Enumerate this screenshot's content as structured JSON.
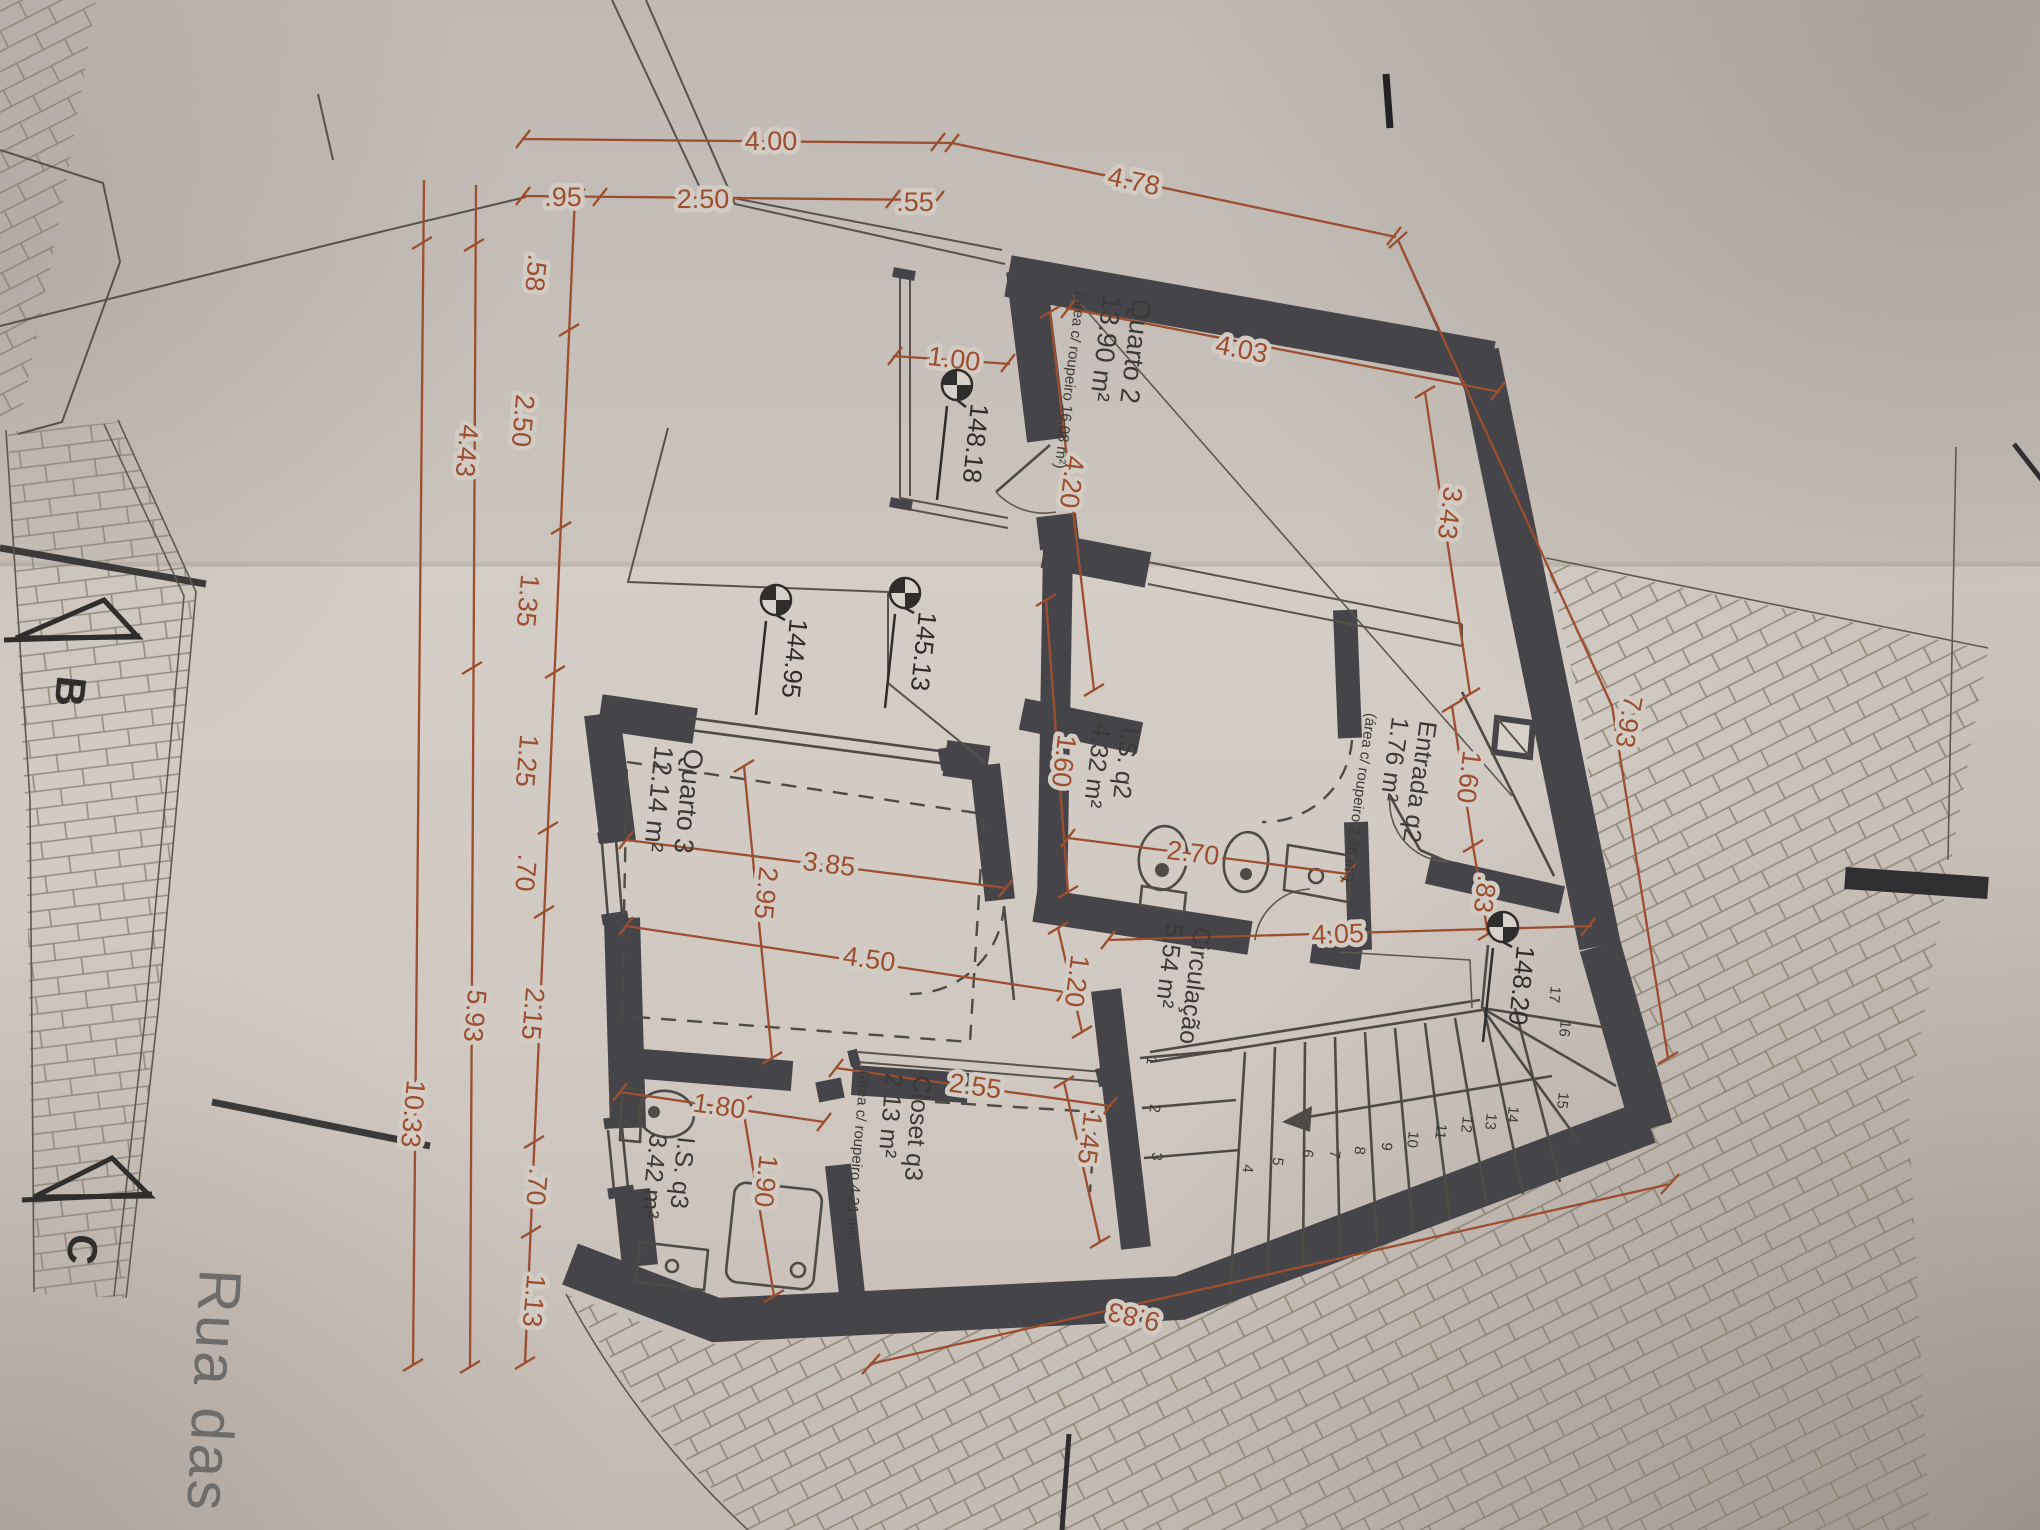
{
  "sheet": {
    "type": "floor-plan-photo",
    "street": "Rua das Fl"
  },
  "colors": {
    "dimension": "#9b4f2e",
    "wall": "#454449",
    "paper": "#d3ccc5"
  },
  "dims": {
    "d400": "4.00",
    "d95": ".95",
    "d250": "2.50",
    "d55": ".55",
    "d478": "4.78",
    "d100": "1.00",
    "d403": "4.03",
    "d420": "4.20",
    "d343": "3.43",
    "d160e": "1.60",
    "d83": ".83",
    "d793": "7.93",
    "d160i": "1.60",
    "d270": "2.70",
    "d405": "4.05",
    "d120": "1.20",
    "d385": "3.85",
    "d295": "2.95",
    "d450": "4.50",
    "d180": "1.80",
    "d190": "1.90",
    "d255": "2.55",
    "d145": "1.45",
    "d983": "9.83",
    "left": {
      "a58": ".58",
      "a250": "2.50",
      "a135": "1.35",
      "a125": "1.25",
      "a70a": ".70",
      "a215": "2.15",
      "a70b": ".70",
      "a113": "1.13",
      "b443": "4.43",
      "b593": "5.93",
      "c1033": "10.33"
    }
  },
  "rooms": {
    "quarto2": {
      "name": "Quarto 2",
      "area": "13.90 m²",
      "note": "(área c/ roupeiro 16.08 m²)"
    },
    "entrada": {
      "name": "Entrada q2",
      "area": "1.76 m²",
      "note": "(área c/ roupeiro 2.76 m²)"
    },
    "is_q2": {
      "name": "I.S. q2",
      "area": "4.32 m²"
    },
    "circulacao": {
      "name": "Circulação",
      "area": "5.54 m²"
    },
    "quarto3": {
      "name": "Quarto 3",
      "area": "12.14 m²"
    },
    "closet": {
      "name": "Closet q3",
      "area": "2.13 m²",
      "note": "(área c/ roupeiro 4.21 m²)"
    },
    "is_q3": {
      "name": "I.S. q3",
      "area": "3.42 m²"
    }
  },
  "levels": {
    "l1": "148.18",
    "l2": "144.95",
    "l3": "145.13",
    "l4": "148.20"
  },
  "sections": {
    "b": "B",
    "c": "C"
  },
  "street": {
    "name": "Rua das Fl"
  },
  "stairs": {
    "treads": [
      "1",
      "2",
      "3",
      "4",
      "5",
      "6",
      "7",
      "8",
      "9",
      "10",
      "11",
      "12",
      "13",
      "14",
      "15",
      "16",
      "17"
    ]
  }
}
